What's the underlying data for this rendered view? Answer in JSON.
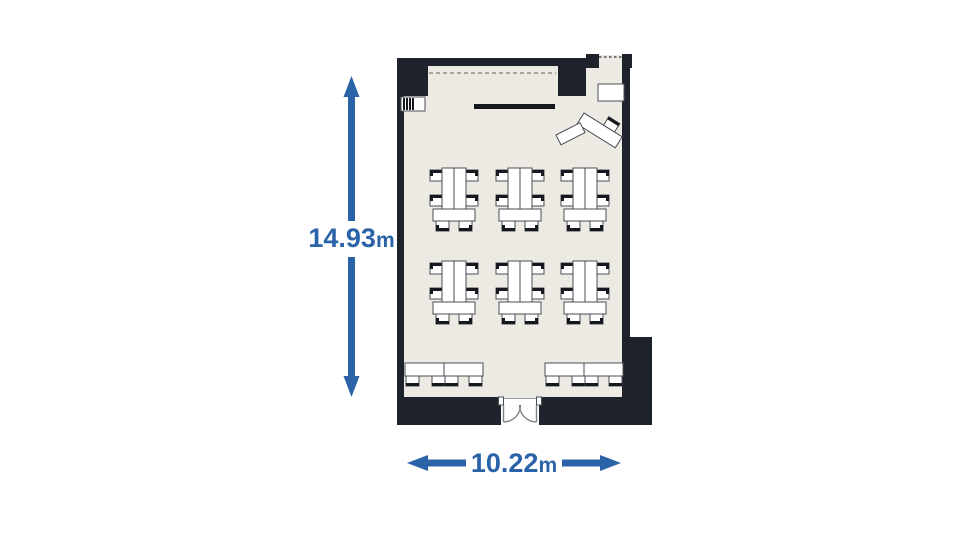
{
  "page": {
    "description": "Room floor plan with overall dimensions",
    "background": "#ffffff"
  },
  "colors": {
    "background": "#ffffff",
    "wall": "#1e222b",
    "floor": "#eceae3",
    "accent": "#2a63a8",
    "furniture_outline": "#4a4e55",
    "chair_back": "#15181f",
    "partition_dash": "#a6a69e"
  },
  "dimensions": {
    "height": {
      "value": "14.93",
      "unit": "m"
    },
    "width": {
      "value": "10.22",
      "unit": "m"
    }
  },
  "floorplan": {
    "room": "classroom-style meeting room",
    "furniture": {
      "classroom_table_groups": 6,
      "back_wall_tables": 2,
      "presenter_desk": 1,
      "side_table": 1,
      "corner_table": 1,
      "whiteboard": 1,
      "radiator": 1,
      "double_door": 1
    }
  }
}
